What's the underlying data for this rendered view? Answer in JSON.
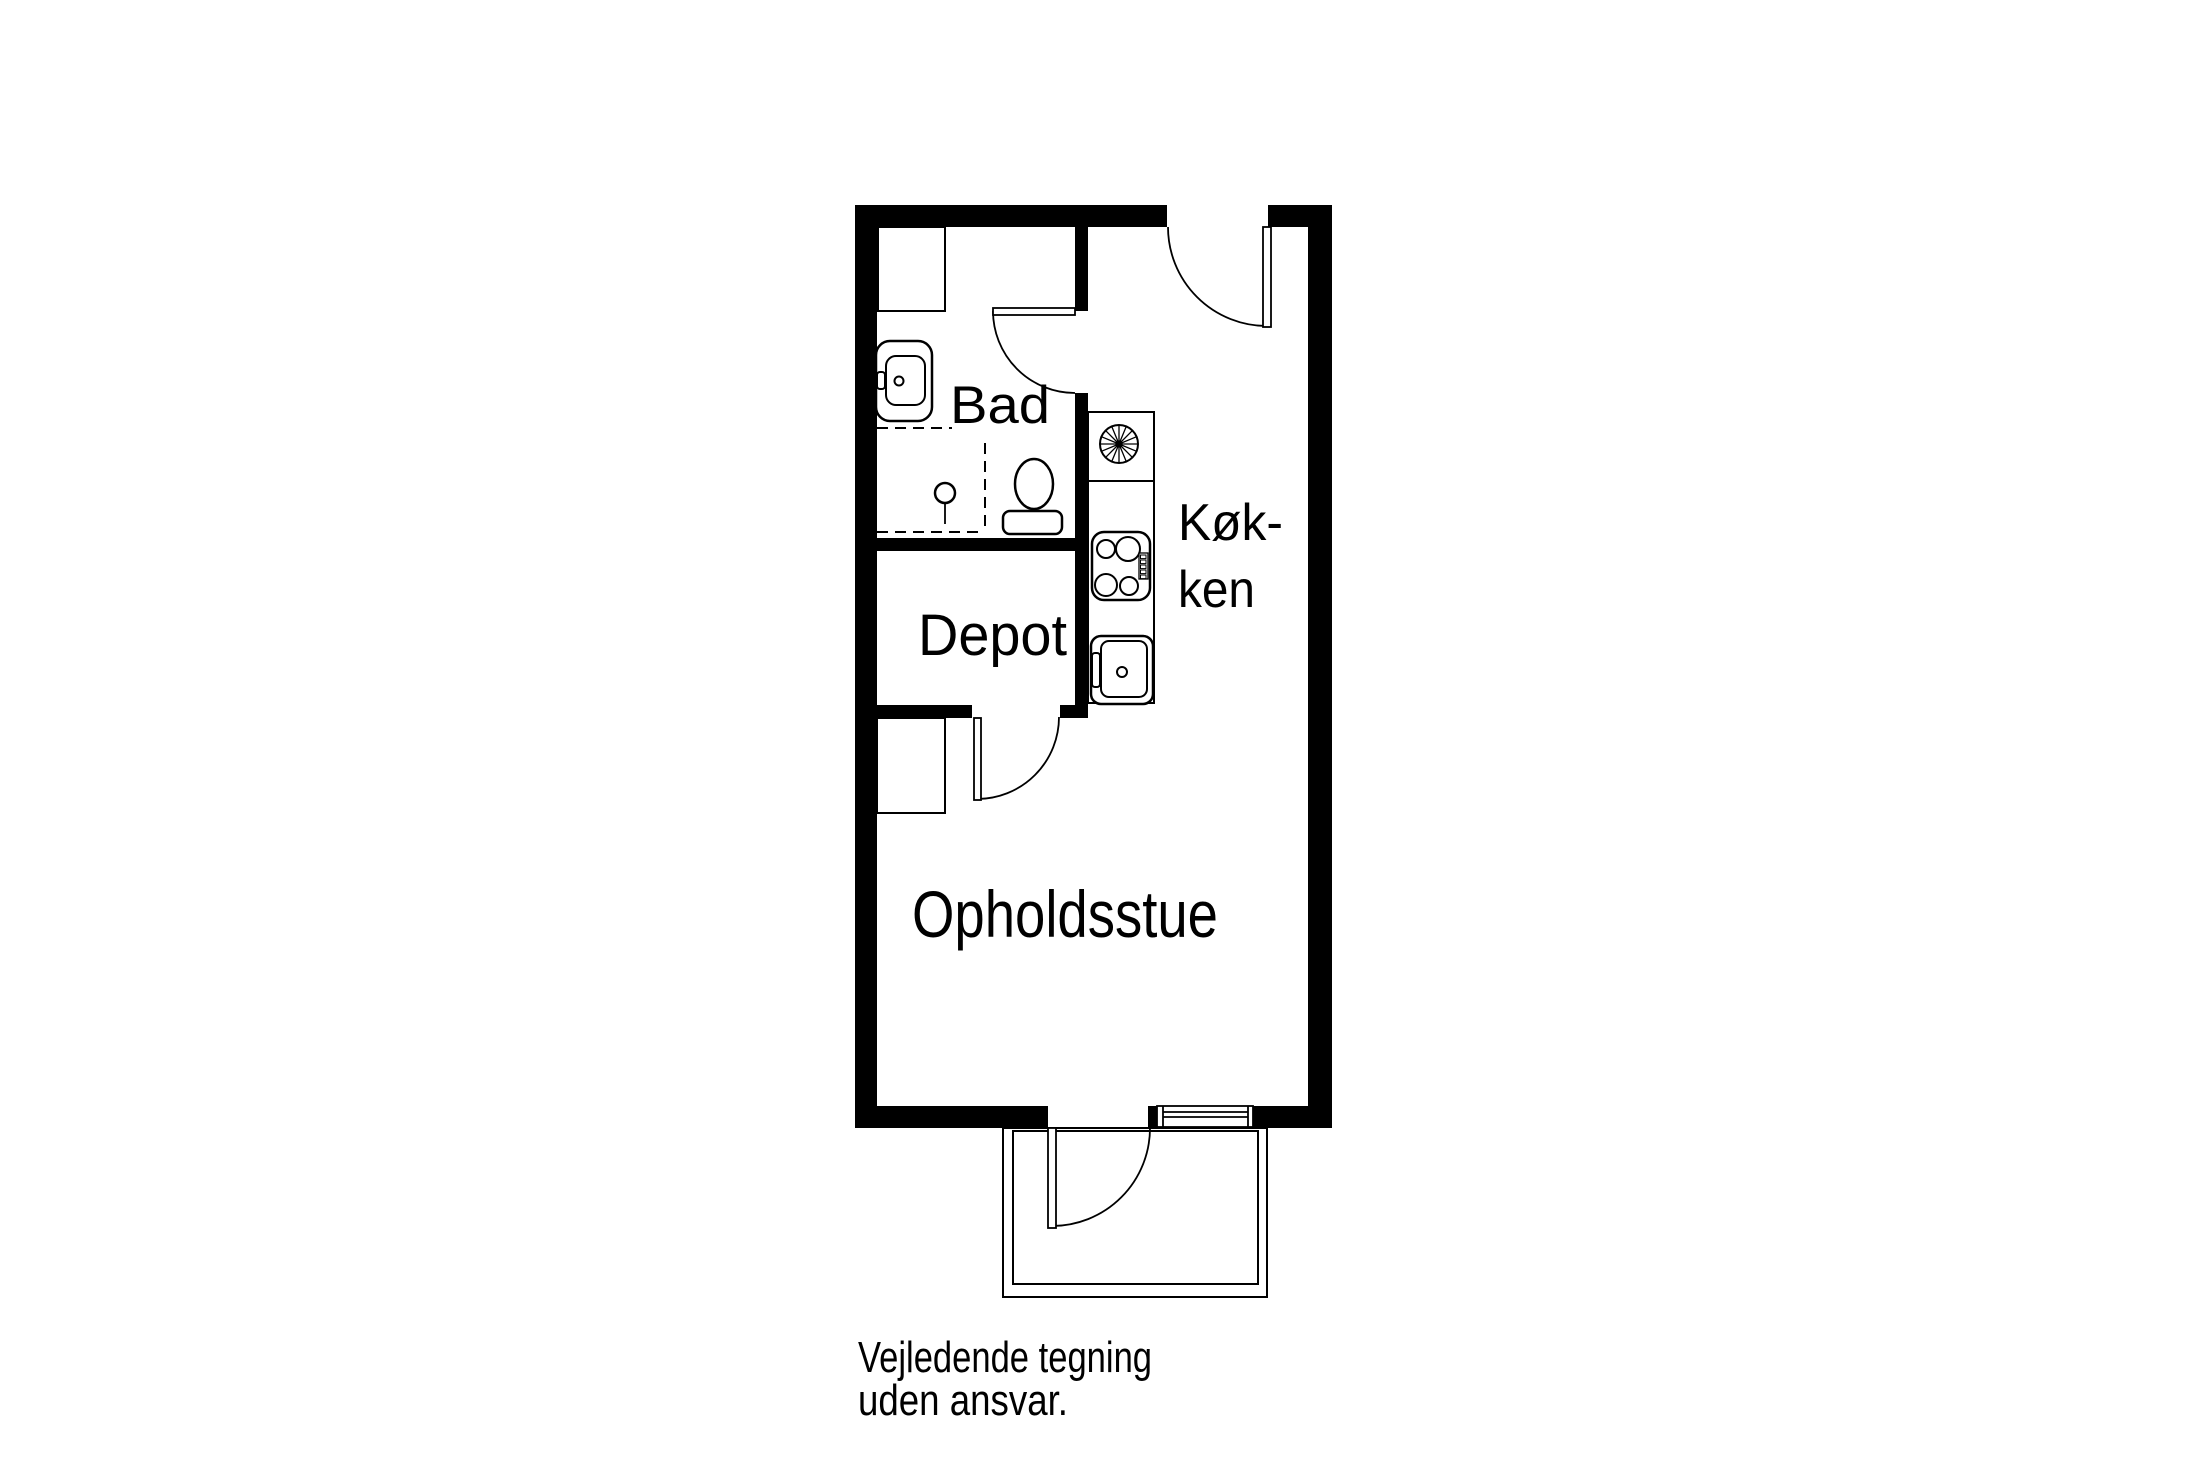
{
  "document": {
    "type": "floor-plan"
  },
  "rooms": {
    "bathroom": {
      "label": "Bad"
    },
    "kitchen": {
      "label_line1": "Køk-",
      "label_line2": "ken"
    },
    "storage": {
      "label": "Depot"
    },
    "living_room": {
      "label": "Opholdsstue"
    }
  },
  "disclaimer": {
    "line1": "Vejledende tegning",
    "line2": "uden ansvar."
  },
  "fixtures": [
    "bathroom-sink",
    "shower-head",
    "shower-area",
    "toilet",
    "bathroom-cabinet",
    "wardrobe",
    "extractor-fan",
    "cooktop",
    "kitchen-sink",
    "kitchen-counter",
    "entry-door",
    "bathroom-door",
    "hallway-door",
    "porch-door",
    "window",
    "entrance-porch"
  ],
  "colors": {
    "walls": "#000000",
    "lines": "#000000",
    "text": "#000000",
    "background": "#ffffff"
  }
}
